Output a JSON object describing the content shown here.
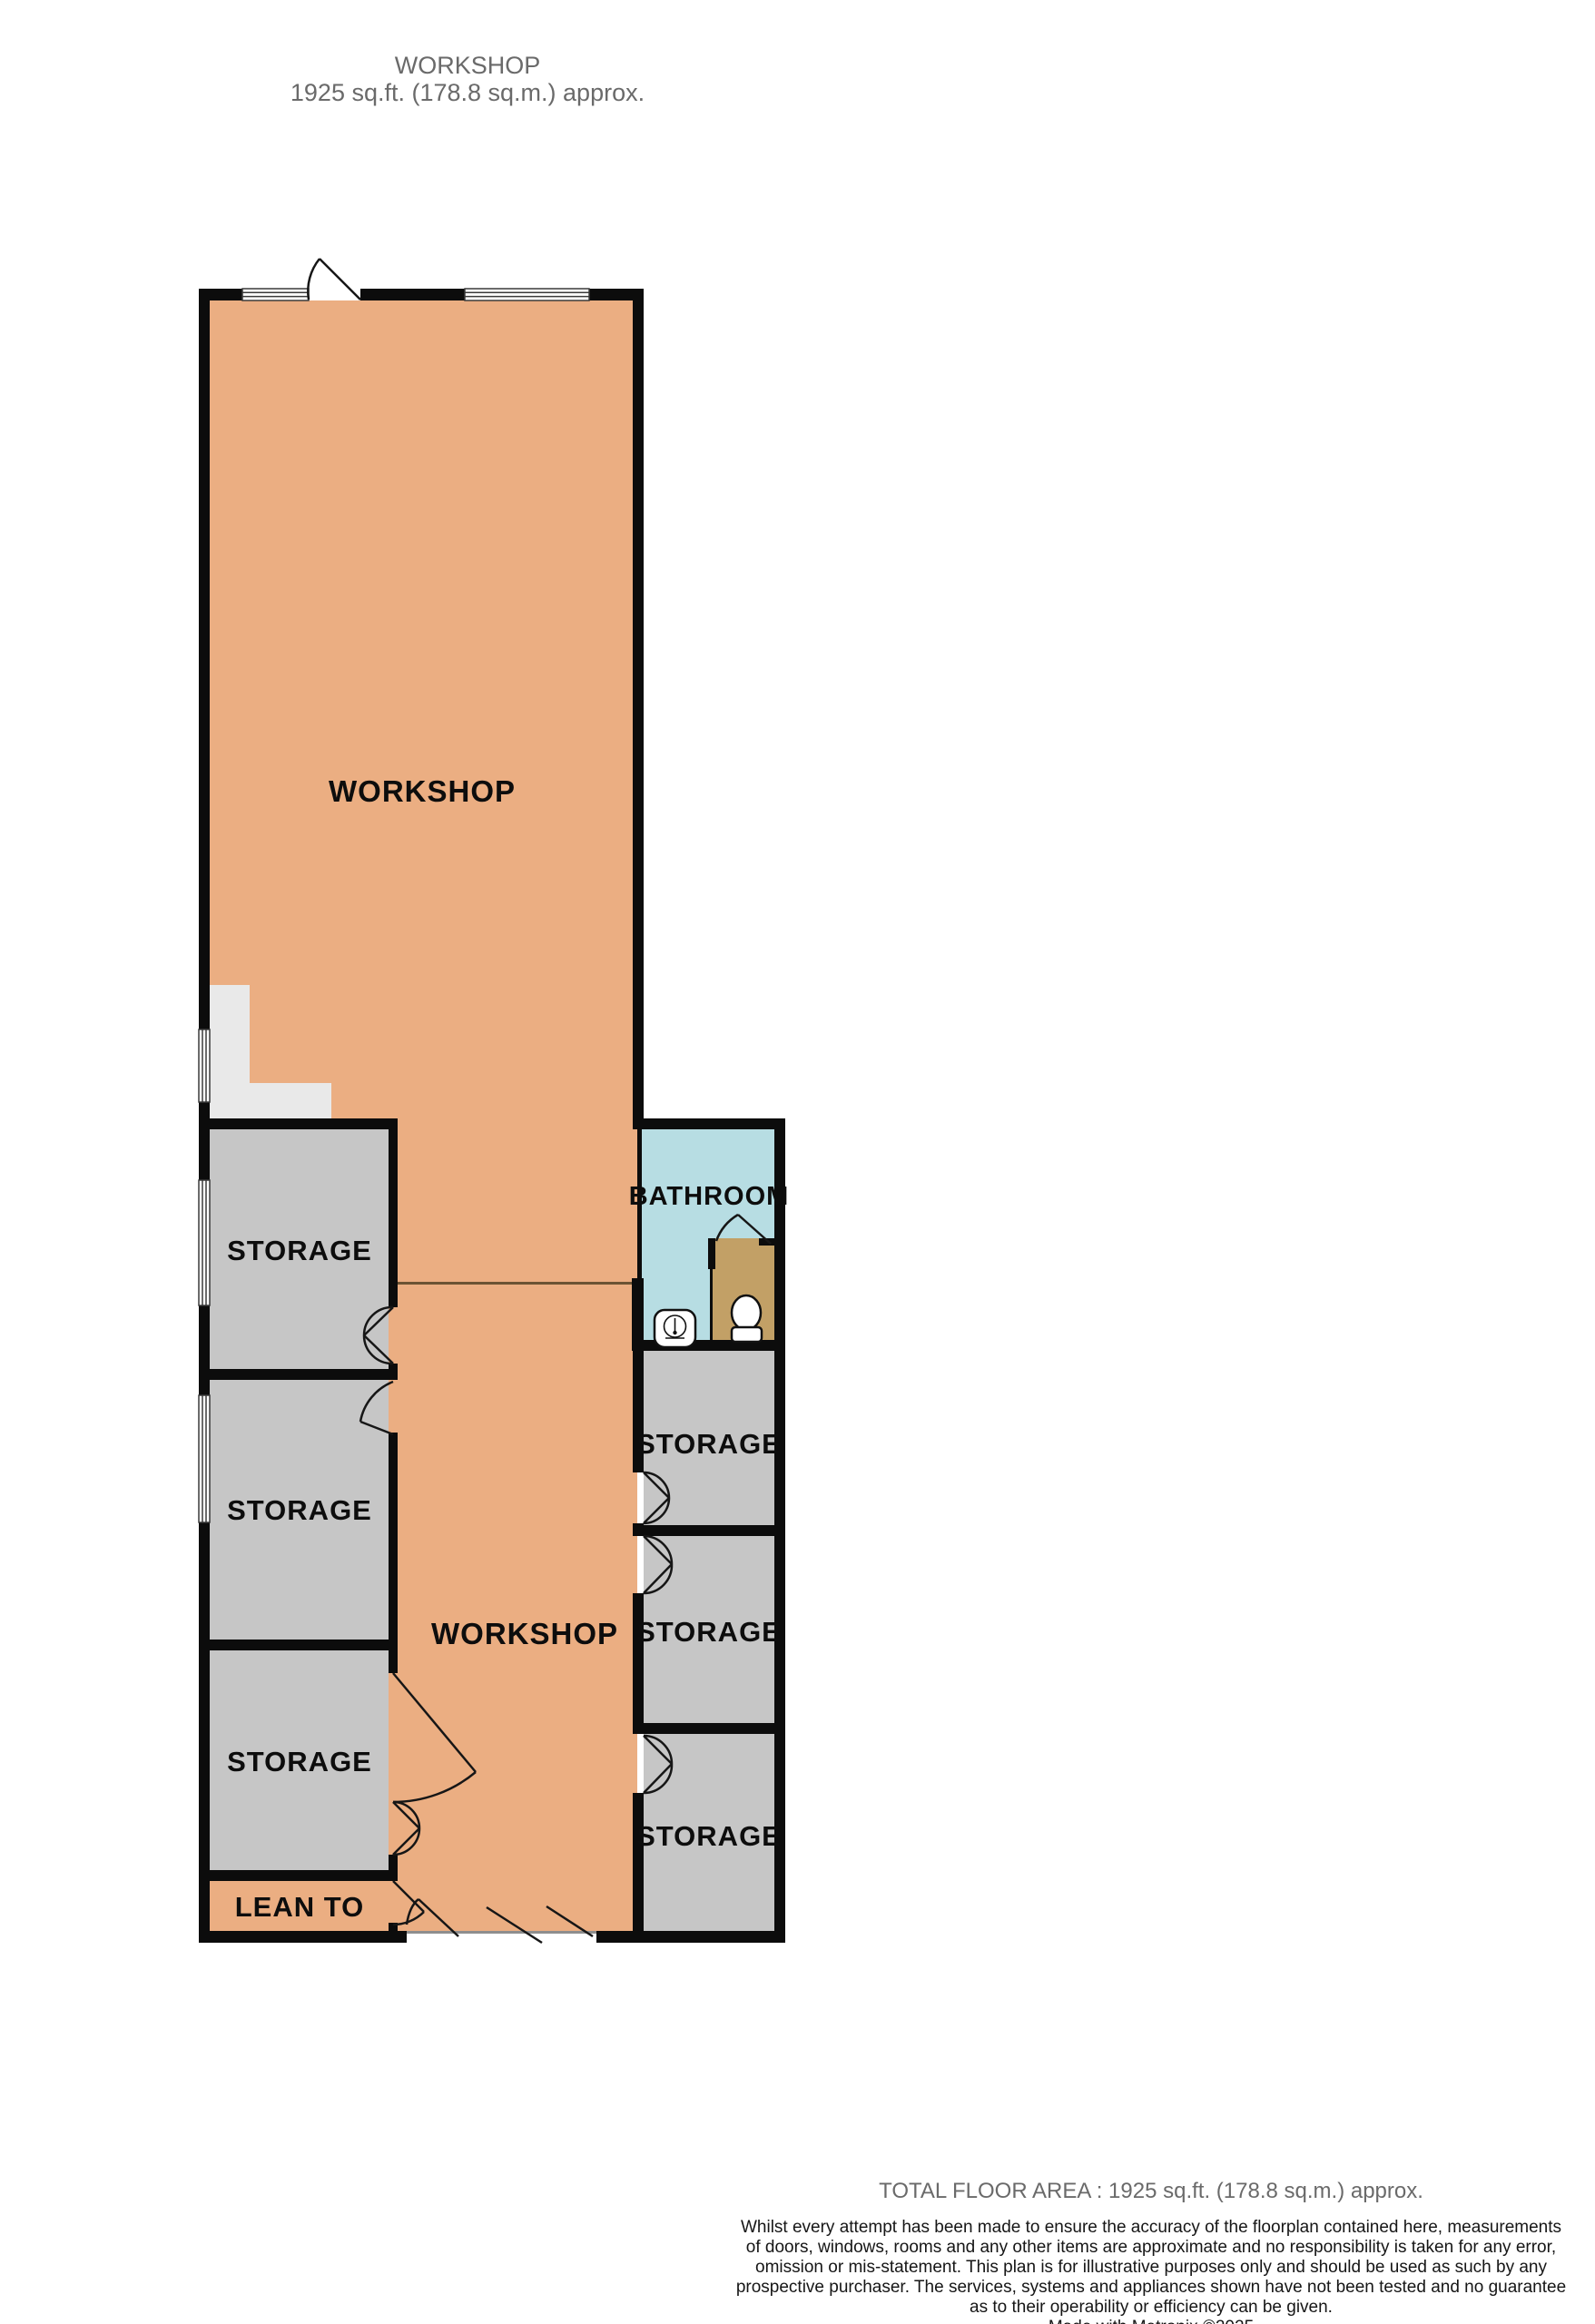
{
  "title": {
    "line1": "WORKSHOP",
    "line2": "1925 sq.ft. (178.8 sq.m.) approx."
  },
  "plan": {
    "labels": [
      {
        "id": "workshop-upper",
        "text": "WORKSHOP"
      },
      {
        "id": "workshop-lower",
        "text": "WORKSHOP"
      },
      {
        "id": "storage-left-1",
        "text": "STORAGE"
      },
      {
        "id": "storage-left-2",
        "text": "STORAGE"
      },
      {
        "id": "storage-left-3",
        "text": "STORAGE"
      },
      {
        "id": "lean-to",
        "text": "LEAN TO"
      },
      {
        "id": "bathroom",
        "text": "BATHROOM"
      },
      {
        "id": "storage-right-1",
        "text": "STORAGE"
      },
      {
        "id": "storage-right-2",
        "text": "STORAGE"
      },
      {
        "id": "storage-right-3",
        "text": "STORAGE"
      }
    ]
  },
  "footer": {
    "total_area": "TOTAL FLOOR AREA : 1925 sq.ft. (178.8 sq.m.) approx.",
    "disclaimer_lines": [
      "Whilst every attempt has been made to ensure the accuracy of the floorplan contained here, measurements",
      "of doors, windows, rooms and any other items are approximate and no responsibility is taken for any error,",
      "omission or mis-statement. This plan is for illustrative purposes only and should be used as such by any",
      "prospective purchaser. The services, systems and appliances shown have not been tested and no guarantee",
      "as to their operability or efficiency can be given."
    ],
    "credit": "Made with Metropix ©2025"
  },
  "colors": {
    "workshop_floor": "#ebae82",
    "storage_floor": "#c6c6c6",
    "stairs": "#e9e9e9",
    "bathroom_floor": "#b7dde3",
    "cubicle_floor": "#c2a066",
    "wall": "#0c0c0c",
    "muted_text": "#6a6a6a",
    "divider_line": "#6b5333"
  }
}
